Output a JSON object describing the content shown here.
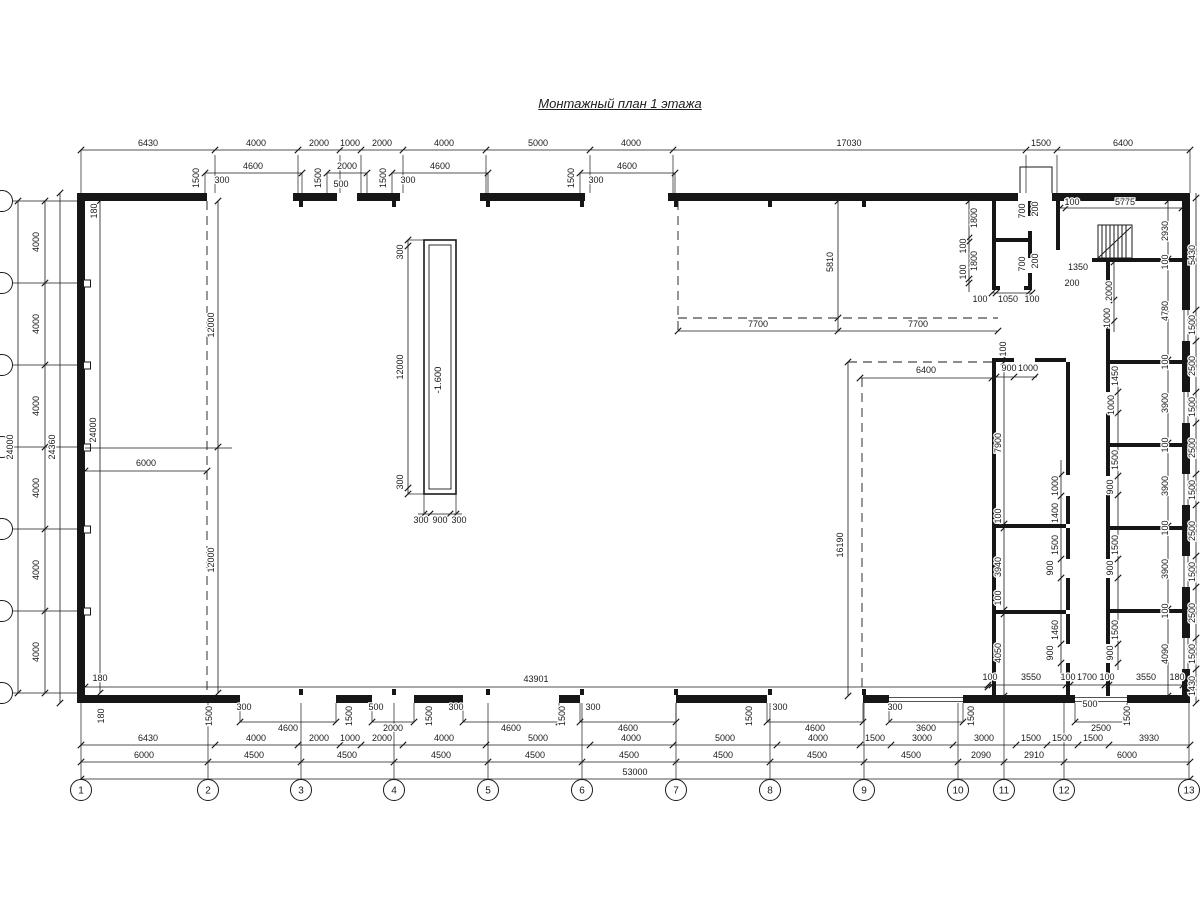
{
  "title": "Монтажный план 1 этажа",
  "colors": {
    "line": "#1a1a1a",
    "wall": "#161616",
    "bg": "#ffffff"
  },
  "pit_label": "-1.600",
  "axes_bottom": [
    {
      "label": "1",
      "x": 81
    },
    {
      "label": "2",
      "x": 208
    },
    {
      "label": "3",
      "x": 301
    },
    {
      "label": "4",
      "x": 394
    },
    {
      "label": "5",
      "x": 488
    },
    {
      "label": "6",
      "x": 582
    },
    {
      "label": "7",
      "x": 676
    },
    {
      "label": "8",
      "x": 770
    },
    {
      "label": "9",
      "x": 864
    },
    {
      "label": "10",
      "x": 958
    },
    {
      "label": "11",
      "x": 1004
    },
    {
      "label": "12",
      "x": 1064
    },
    {
      "label": "13",
      "x": 1189
    }
  ],
  "dims": [
    {
      "t": "6430",
      "x": 148,
      "y": 146
    },
    {
      "t": "4000",
      "x": 256,
      "y": 146
    },
    {
      "t": "2000",
      "x": 319,
      "y": 146
    },
    {
      "t": "1000",
      "x": 350,
      "y": 146
    },
    {
      "t": "2000",
      "x": 382,
      "y": 146
    },
    {
      "t": "4000",
      "x": 444,
      "y": 146
    },
    {
      "t": "5000",
      "x": 538,
      "y": 146
    },
    {
      "t": "4000",
      "x": 631,
      "y": 146
    },
    {
      "t": "17030",
      "x": 849,
      "y": 146
    },
    {
      "t": "1500",
      "x": 1041,
      "y": 146
    },
    {
      "t": "6400",
      "x": 1123,
      "y": 146
    },
    {
      "t": "4600",
      "x": 253,
      "y": 169
    },
    {
      "t": "2000",
      "x": 347,
      "y": 169
    },
    {
      "t": "4600",
      "x": 440,
      "y": 169
    },
    {
      "t": "4600",
      "x": 627,
      "y": 169
    },
    {
      "t": "1500",
      "x": 199,
      "y": 178,
      "r": 1
    },
    {
      "t": "300",
      "x": 222,
      "y": 183
    },
    {
      "t": "1500",
      "x": 321,
      "y": 178,
      "r": 1
    },
    {
      "t": "500",
      "x": 341,
      "y": 187
    },
    {
      "t": "1500",
      "x": 386,
      "y": 178,
      "r": 1
    },
    {
      "t": "300",
      "x": 408,
      "y": 183
    },
    {
      "t": "1500",
      "x": 574,
      "y": 178,
      "r": 1
    },
    {
      "t": "300",
      "x": 596,
      "y": 183
    },
    {
      "t": "1800",
      "x": 977,
      "y": 218,
      "r": 1
    },
    {
      "t": "100",
      "x": 966,
      "y": 246,
      "r": 1
    },
    {
      "t": "1800",
      "x": 977,
      "y": 261,
      "r": 1
    },
    {
      "t": "100",
      "x": 966,
      "y": 272,
      "r": 1
    },
    {
      "t": "700",
      "x": 1025,
      "y": 211,
      "r": 1
    },
    {
      "t": "200",
      "x": 1038,
      "y": 209,
      "r": 1
    },
    {
      "t": "700",
      "x": 1025,
      "y": 264,
      "r": 1
    },
    {
      "t": "200",
      "x": 1038,
      "y": 261,
      "r": 1
    },
    {
      "t": "100",
      "x": 980,
      "y": 302
    },
    {
      "t": "1050",
      "x": 1008,
      "y": 302
    },
    {
      "t": "100",
      "x": 1032,
      "y": 302
    },
    {
      "t": "100",
      "x": 1072,
      "y": 205
    },
    {
      "t": "5775",
      "x": 1125,
      "y": 205
    },
    {
      "t": "1350",
      "x": 1078,
      "y": 270
    },
    {
      "t": "200",
      "x": 1072,
      "y": 286
    },
    {
      "t": "2000",
      "x": 1112,
      "y": 291,
      "r": 1
    },
    {
      "t": "1000",
      "x": 1110,
      "y": 318,
      "r": 1
    },
    {
      "t": "5810",
      "x": 833,
      "y": 262,
      "r": 1
    },
    {
      "t": "7700",
      "x": 758,
      "y": 327
    },
    {
      "t": "7700",
      "x": 918,
      "y": 327
    },
    {
      "t": "6400",
      "x": 926,
      "y": 373
    },
    {
      "t": "16190",
      "x": 843,
      "y": 545,
      "r": 1
    },
    {
      "t": "100",
      "x": 1006,
      "y": 349,
      "r": 1
    },
    {
      "t": "900",
      "x": 1009,
      "y": 371
    },
    {
      "t": "1000",
      "x": 1028,
      "y": 371
    },
    {
      "t": "7900",
      "x": 1001,
      "y": 443,
      "r": 1
    },
    {
      "t": "100",
      "x": 1001,
      "y": 516,
      "r": 1
    },
    {
      "t": "3940",
      "x": 1001,
      "y": 567,
      "r": 1
    },
    {
      "t": "100",
      "x": 1001,
      "y": 598,
      "r": 1
    },
    {
      "t": "4050",
      "x": 1001,
      "y": 653,
      "r": 1
    },
    {
      "t": "1000",
      "x": 1058,
      "y": 486,
      "r": 1
    },
    {
      "t": "1400",
      "x": 1058,
      "y": 513,
      "r": 1
    },
    {
      "t": "1500",
      "x": 1058,
      "y": 545,
      "r": 1
    },
    {
      "t": "900",
      "x": 1053,
      "y": 568,
      "r": 1
    },
    {
      "t": "1460",
      "x": 1058,
      "y": 630,
      "r": 1
    },
    {
      "t": "900",
      "x": 1053,
      "y": 653,
      "r": 1
    },
    {
      "t": "1450",
      "x": 1118,
      "y": 376,
      "r": 1
    },
    {
      "t": "1000",
      "x": 1114,
      "y": 405,
      "r": 1
    },
    {
      "t": "1500",
      "x": 1118,
      "y": 460,
      "r": 1
    },
    {
      "t": "900",
      "x": 1113,
      "y": 487,
      "r": 1
    },
    {
      "t": "1500",
      "x": 1118,
      "y": 545,
      "r": 1
    },
    {
      "t": "900",
      "x": 1113,
      "y": 568,
      "r": 1
    },
    {
      "t": "1500",
      "x": 1118,
      "y": 630,
      "r": 1
    },
    {
      "t": "900",
      "x": 1113,
      "y": 653,
      "r": 1
    },
    {
      "t": "2930",
      "x": 1168,
      "y": 231,
      "r": 1
    },
    {
      "t": "100",
      "x": 1168,
      "y": 262,
      "r": 1
    },
    {
      "t": "4780",
      "x": 1168,
      "y": 311,
      "r": 1
    },
    {
      "t": "100",
      "x": 1168,
      "y": 362,
      "r": 1
    },
    {
      "t": "3900",
      "x": 1168,
      "y": 403,
      "r": 1
    },
    {
      "t": "100",
      "x": 1168,
      "y": 445,
      "r": 1
    },
    {
      "t": "3900",
      "x": 1168,
      "y": 486,
      "r": 1
    },
    {
      "t": "100",
      "x": 1168,
      "y": 528,
      "r": 1
    },
    {
      "t": "3900",
      "x": 1168,
      "y": 569,
      "r": 1
    },
    {
      "t": "100",
      "x": 1168,
      "y": 611,
      "r": 1
    },
    {
      "t": "4090",
      "x": 1168,
      "y": 654,
      "r": 1
    },
    {
      "t": "5430",
      "x": 1195,
      "y": 255,
      "r": 1
    },
    {
      "t": "1500",
      "x": 1195,
      "y": 325,
      "r": 1
    },
    {
      "t": "2500",
      "x": 1195,
      "y": 366,
      "r": 1
    },
    {
      "t": "1500",
      "x": 1195,
      "y": 407,
      "r": 1
    },
    {
      "t": "2500",
      "x": 1195,
      "y": 448,
      "r": 1
    },
    {
      "t": "1500",
      "x": 1195,
      "y": 490,
      "r": 1
    },
    {
      "t": "2500",
      "x": 1195,
      "y": 531,
      "r": 1
    },
    {
      "t": "1500",
      "x": 1195,
      "y": 572,
      "r": 1
    },
    {
      "t": "2500",
      "x": 1195,
      "y": 613,
      "r": 1
    },
    {
      "t": "1500",
      "x": 1195,
      "y": 654,
      "r": 1
    },
    {
      "t": "1430",
      "x": 1195,
      "y": 686,
      "r": 1
    },
    {
      "t": "100",
      "x": 990,
      "y": 680
    },
    {
      "t": "3550",
      "x": 1031,
      "y": 680
    },
    {
      "t": "100",
      "x": 1068,
      "y": 680
    },
    {
      "t": "1700",
      "x": 1087,
      "y": 680
    },
    {
      "t": "100",
      "x": 1107,
      "y": 680
    },
    {
      "t": "3550",
      "x": 1146,
      "y": 680
    },
    {
      "t": "180",
      "x": 1177,
      "y": 680
    },
    {
      "t": "300",
      "x": 403,
      "y": 252,
      "r": 1
    },
    {
      "t": "12000",
      "x": 403,
      "y": 367,
      "r": 1
    },
    {
      "t": "300",
      "x": 403,
      "y": 482,
      "r": 1
    },
    {
      "t": "300",
      "x": 421,
      "y": 523
    },
    {
      "t": "900",
      "x": 440,
      "y": 523
    },
    {
      "t": "300",
      "x": 459,
      "y": 523
    },
    {
      "t": "24000",
      "x": 13,
      "y": 447,
      "r": 1
    },
    {
      "t": "4000",
      "x": 39,
      "y": 242,
      "r": 1
    },
    {
      "t": "4000",
      "x": 39,
      "y": 324,
      "r": 1
    },
    {
      "t": "4000",
      "x": 39,
      "y": 406,
      "r": 1
    },
    {
      "t": "4000",
      "x": 39,
      "y": 488,
      "r": 1
    },
    {
      "t": "4000",
      "x": 39,
      "y": 570,
      "r": 1
    },
    {
      "t": "4000",
      "x": 39,
      "y": 652,
      "r": 1
    },
    {
      "t": "24360",
      "x": 55,
      "y": 447,
      "r": 1
    },
    {
      "t": "24000",
      "x": 96,
      "y": 430,
      "r": 1
    },
    {
      "t": "180",
      "x": 97,
      "y": 211,
      "r": 1
    },
    {
      "t": "180",
      "x": 100,
      "y": 681
    },
    {
      "t": "180",
      "x": 104,
      "y": 716,
      "r": 1
    },
    {
      "t": "12000",
      "x": 214,
      "y": 325,
      "r": 1
    },
    {
      "t": "12000",
      "x": 214,
      "y": 560,
      "r": 1
    },
    {
      "t": "6000",
      "x": 146,
      "y": 466
    },
    {
      "t": "1500",
      "x": 212,
      "y": 716,
      "r": 1
    },
    {
      "t": "300",
      "x": 244,
      "y": 710
    },
    {
      "t": "4600",
      "x": 288,
      "y": 731
    },
    {
      "t": "1500",
      "x": 352,
      "y": 716,
      "r": 1
    },
    {
      "t": "500",
      "x": 376,
      "y": 710
    },
    {
      "t": "2000",
      "x": 393,
      "y": 731
    },
    {
      "t": "1500",
      "x": 432,
      "y": 716,
      "r": 1
    },
    {
      "t": "300",
      "x": 456,
      "y": 710
    },
    {
      "t": "4600",
      "x": 511,
      "y": 731
    },
    {
      "t": "1500",
      "x": 565,
      "y": 716,
      "r": 1
    },
    {
      "t": "300",
      "x": 593,
      "y": 710
    },
    {
      "t": "4600",
      "x": 628,
      "y": 731
    },
    {
      "t": "1500",
      "x": 752,
      "y": 716,
      "r": 1
    },
    {
      "t": "300",
      "x": 780,
      "y": 710
    },
    {
      "t": "4600",
      "x": 815,
      "y": 731
    },
    {
      "t": "300",
      "x": 895,
      "y": 710
    },
    {
      "t": "3600",
      "x": 926,
      "y": 731
    },
    {
      "t": "1500",
      "x": 974,
      "y": 716,
      "r": 1
    },
    {
      "t": "500",
      "x": 1090,
      "y": 707
    },
    {
      "t": "2500",
      "x": 1101,
      "y": 731
    },
    {
      "t": "1500",
      "x": 1130,
      "y": 716,
      "r": 1
    },
    {
      "t": "43901",
      "x": 536,
      "y": 682
    },
    {
      "t": "6430",
      "x": 148,
      "y": 741
    },
    {
      "t": "4000",
      "x": 256,
      "y": 741
    },
    {
      "t": "2000",
      "x": 319,
      "y": 741
    },
    {
      "t": "1000",
      "x": 350,
      "y": 741
    },
    {
      "t": "2000",
      "x": 382,
      "y": 741
    },
    {
      "t": "4000",
      "x": 444,
      "y": 741
    },
    {
      "t": "5000",
      "x": 538,
      "y": 741
    },
    {
      "t": "4000",
      "x": 631,
      "y": 741
    },
    {
      "t": "5000",
      "x": 725,
      "y": 741
    },
    {
      "t": "4000",
      "x": 818,
      "y": 741
    },
    {
      "t": "1500",
      "x": 875,
      "y": 741
    },
    {
      "t": "3000",
      "x": 922,
      "y": 741
    },
    {
      "t": "3000",
      "x": 984,
      "y": 741
    },
    {
      "t": "1500",
      "x": 1031,
      "y": 741
    },
    {
      "t": "1500",
      "x": 1062,
      "y": 741
    },
    {
      "t": "1500",
      "x": 1093,
      "y": 741
    },
    {
      "t": "3930",
      "x": 1149,
      "y": 741
    },
    {
      "t": "6000",
      "x": 144,
      "y": 758
    },
    {
      "t": "4500",
      "x": 254,
      "y": 758
    },
    {
      "t": "4500",
      "x": 347,
      "y": 758
    },
    {
      "t": "4500",
      "x": 441,
      "y": 758
    },
    {
      "t": "4500",
      "x": 535,
      "y": 758
    },
    {
      "t": "4500",
      "x": 629,
      "y": 758
    },
    {
      "t": "4500",
      "x": 723,
      "y": 758
    },
    {
      "t": "4500",
      "x": 817,
      "y": 758
    },
    {
      "t": "4500",
      "x": 911,
      "y": 758
    },
    {
      "t": "2090",
      "x": 981,
      "y": 758
    },
    {
      "t": "2910",
      "x": 1034,
      "y": 758
    },
    {
      "t": "6000",
      "x": 1127,
      "y": 758
    },
    {
      "t": "53000",
      "x": 635,
      "y": 775
    }
  ]
}
